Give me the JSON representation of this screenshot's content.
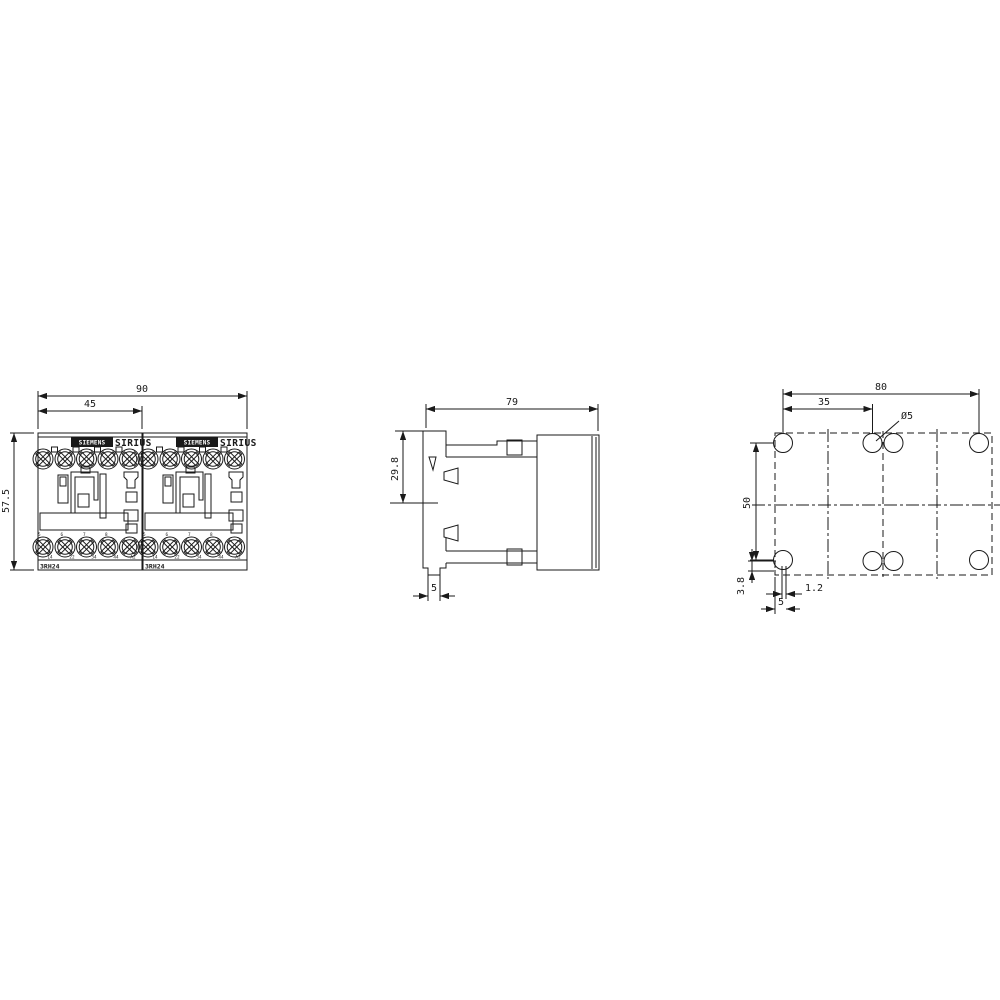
{
  "front_view": {
    "dim_width_total": "90",
    "dim_width_module": "45",
    "dim_height": "57.5",
    "badge_brand": "SIEMENS",
    "series": "SIRIUS",
    "model": "3RH24",
    "terminal_numbers": [
      "5",
      "6",
      "7",
      "8"
    ],
    "terminal_labels": [
      "14",
      "22",
      "34",
      "44",
      "A2"
    ]
  },
  "side_view": {
    "dim_depth": "79",
    "dim_rail_offset": "29.8",
    "dim_foot_width": "5"
  },
  "drill_plan": {
    "dim_hole_span": "80",
    "dim_hole_pitch": "35",
    "dim_hole_diameter": "Ø5",
    "dim_vertical_pitch": "50",
    "dim_edge_offset_v": "3.8",
    "dim_center_offset": "1.2",
    "dim_edge_offset_h": "5"
  }
}
